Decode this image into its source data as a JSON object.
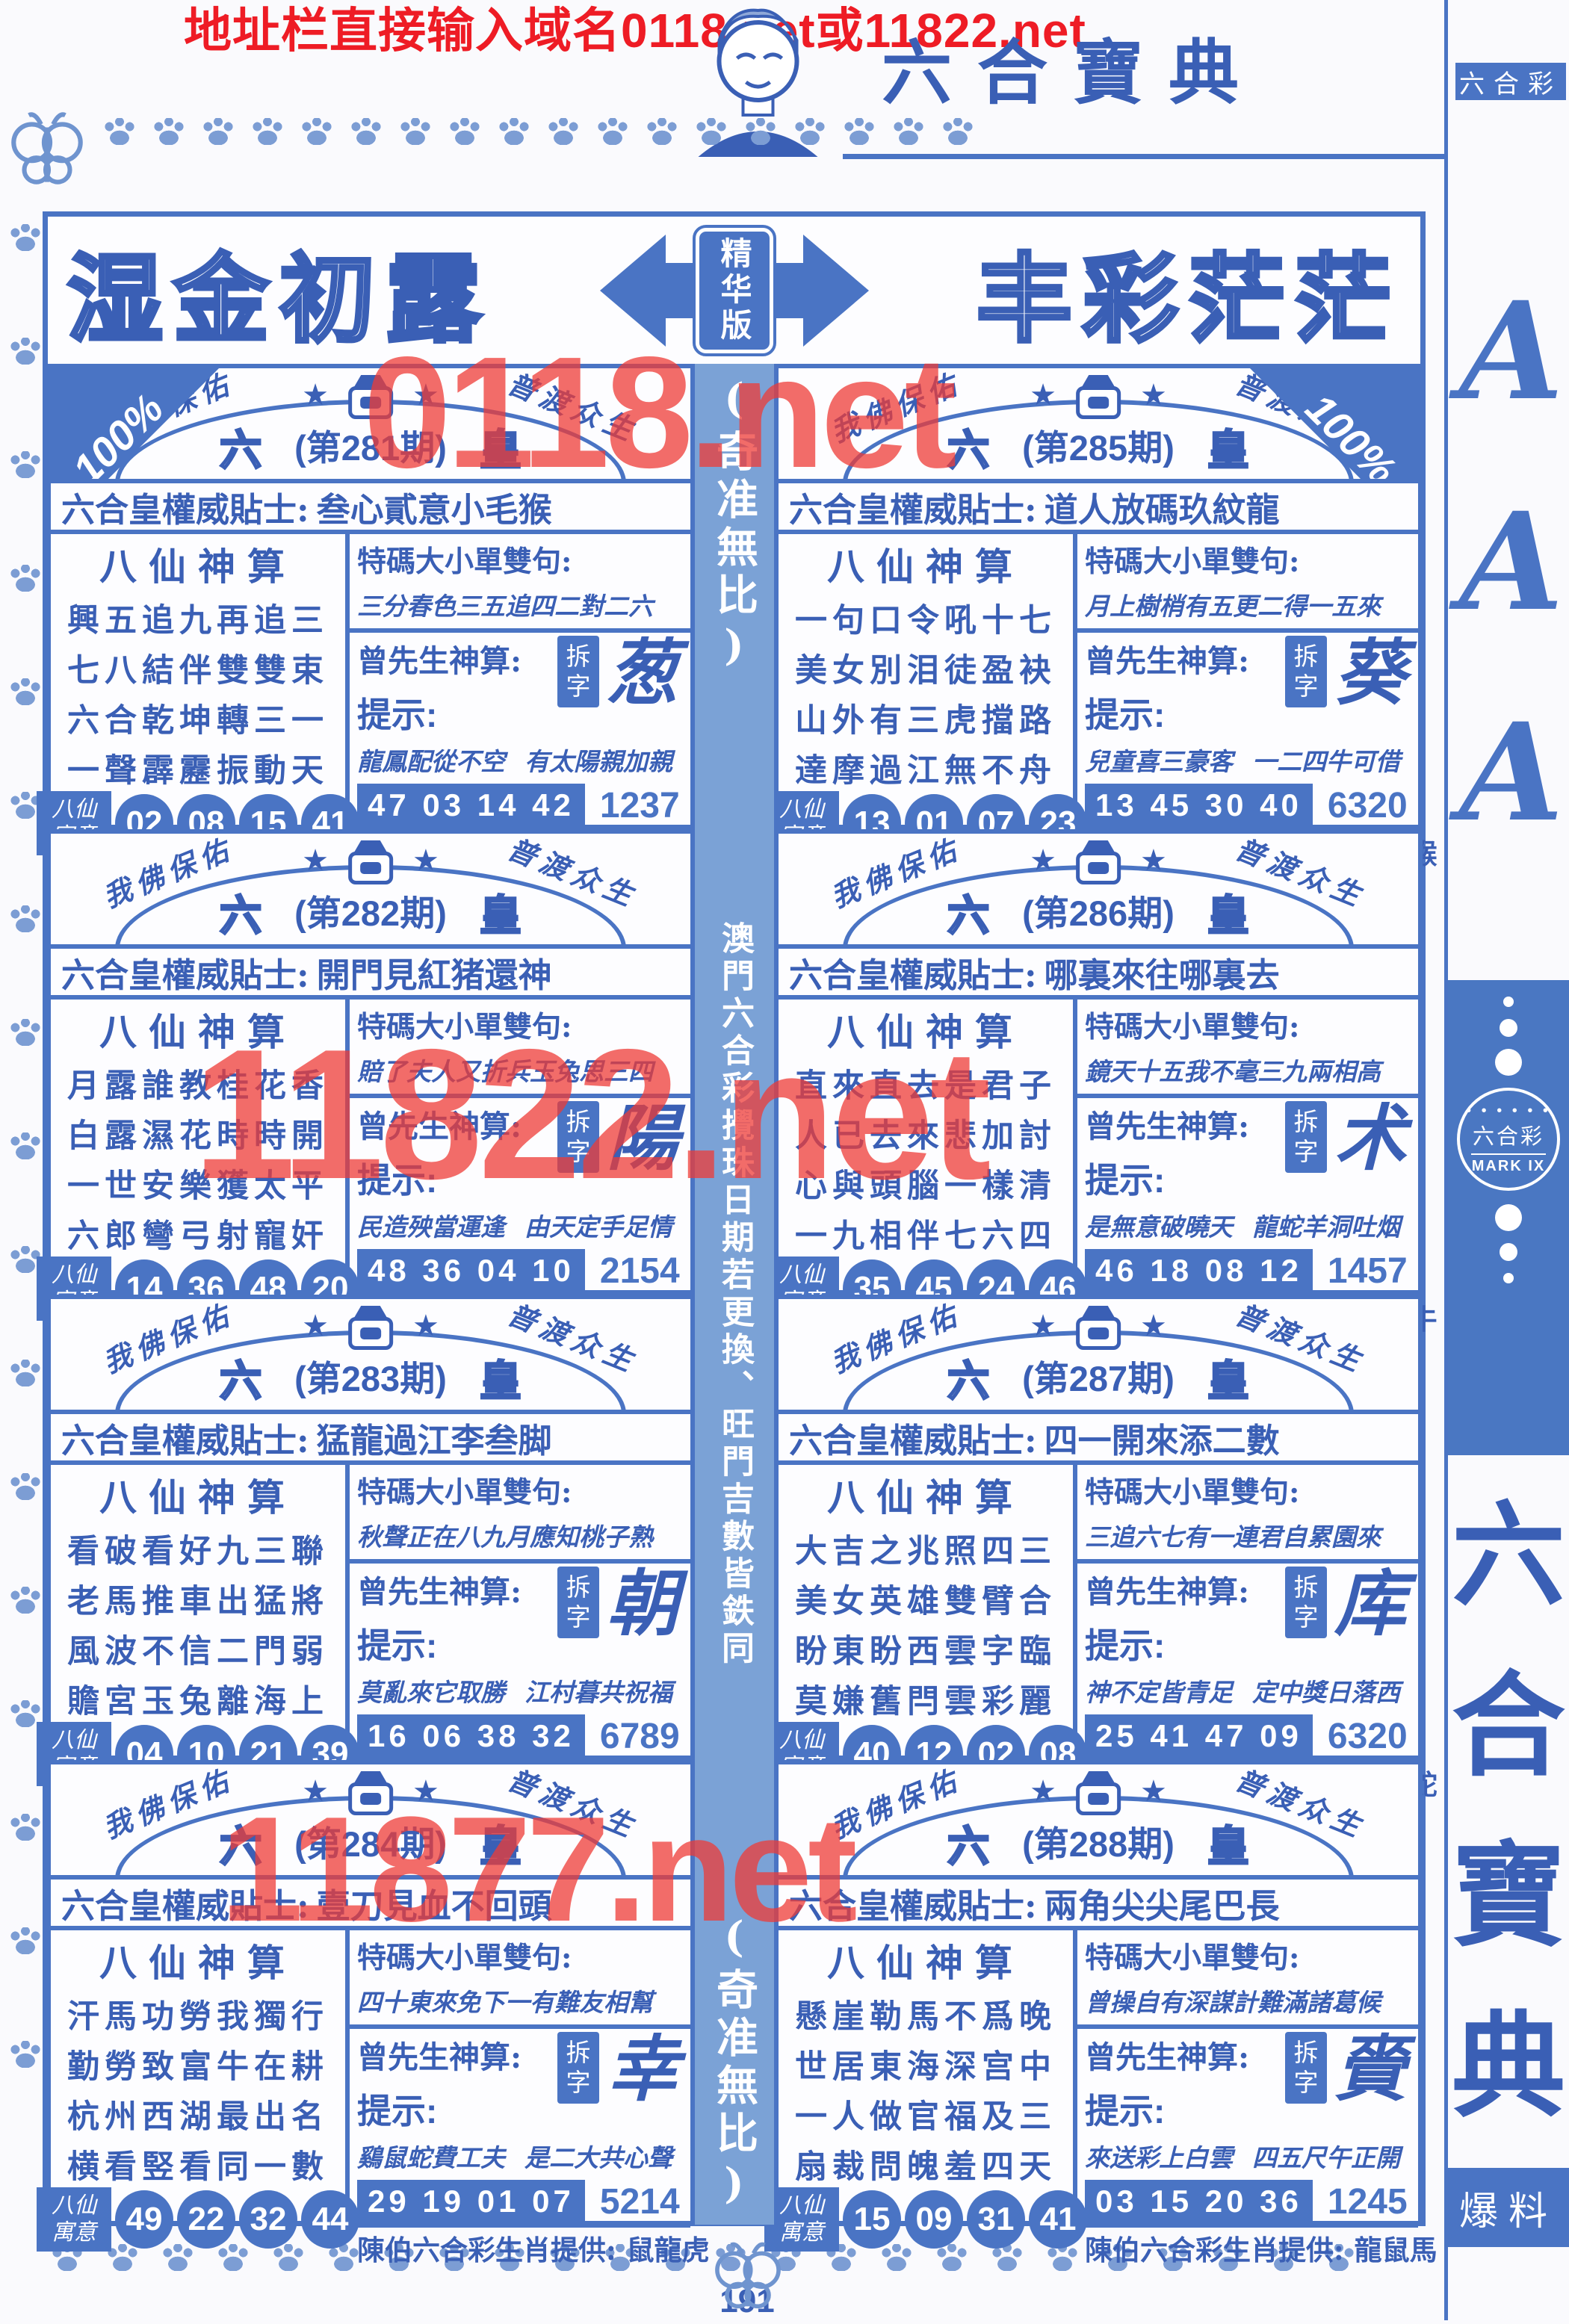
{
  "colors": {
    "accent_blue": "#4a74c4",
    "text_blue": "#3a5fb5",
    "red": "#ee1c25",
    "strip_blue": "#7ba2d6"
  },
  "top_banner": {
    "text": "地址栏直接输入域名0118.net或11822.net"
  },
  "header": {
    "title": "六合寶典"
  },
  "banner": {
    "left_title": "湿金初露",
    "badge": "精华版",
    "right_title": "丰彩茫茫"
  },
  "watermarks": {
    "wm1": "0118.net",
    "wm2": "11822.net",
    "wm3": "11877.net"
  },
  "middle_strip": {
    "top": "(奇准無比)",
    "middle": "澳門六合彩攪珠日期若更換、旺門吉數皆鉄同",
    "bottom": "(奇准無比)"
  },
  "panel_common": {
    "arc_left": "我佛保佑",
    "arc_right": "普渡众生",
    "left_glyph": "六",
    "right_glyph": "皇",
    "corner": "100%",
    "tip_label": "六合皇權威貼士:",
    "baxian_title": "八仙神算",
    "baxian_tag_top": "八仙",
    "baxian_tag_bottom": "寓意",
    "verse_label": "特碼大小單雙句:",
    "zeng_label": "曾先生神算:",
    "chai_top": "拆",
    "chai_bottom": "字",
    "hint_label": "提示:",
    "zodiac_label": "陳伯六合彩生肖提供:"
  },
  "panels": [
    {
      "period": "(第281期)",
      "tip": "叁心貳意小毛猴",
      "poem": [
        "興五追九再追三",
        "七八結伴雙雙束",
        "六合乾坤轉三一",
        "一聲霹靂振動天"
      ],
      "baxian_numbers": [
        "02",
        "08",
        "15",
        "41"
      ],
      "verse": "三分春色三五追四二對二六",
      "chai_char": "葱",
      "hint_left": "龍鳳配從不空",
      "hint_right": "有太陽親加親",
      "numbers": "47 03 14 42",
      "code": "1237",
      "zodiac": "蛇馬鼠"
    },
    {
      "period": "(第285期)",
      "tip": "道人放碼玖紋龍",
      "poem": [
        "一句口令吼十七",
        "美女別泪徒盈袂",
        "山外有三虎擋路",
        "達摩過江無不舟"
      ],
      "baxian_numbers": [
        "13",
        "01",
        "07",
        "23"
      ],
      "verse": "月上樹梢有五更二得一五來",
      "chai_char": "葵",
      "hint_left": "兒童喜三豪客",
      "hint_right": "一二四牛可借",
      "numbers": "13 45 30 40",
      "code": "6320",
      "zodiac": "鶏牛猴"
    },
    {
      "period": "(第282期)",
      "tip": "開門見紅猪還神",
      "poem": [
        "月露誰教桂花香",
        "白露濕花時時開",
        "一世安樂獲太平",
        "六郎彎弓射寵奸"
      ],
      "baxian_numbers": [
        "14",
        "36",
        "48",
        "20"
      ],
      "verse": "賠了夫人又折兵玉兔思三四",
      "chai_char": "陽",
      "hint_left": "民造殃當運逢",
      "hint_right": "由天定手足情",
      "numbers": "48 36 04 10",
      "code": "2154",
      "zodiac": "虎龍猴"
    },
    {
      "period": "(第286期)",
      "tip": "哪裏來往哪裏去",
      "poem": [
        "直來直去是君子",
        "人已去來悲加討",
        "心與頭腦一樣清",
        "一九相伴七六四"
      ],
      "baxian_numbers": [
        "35",
        "45",
        "24",
        "46"
      ],
      "verse": "鏡天十五我不毫三九兩相高",
      "chai_char": "术",
      "hint_left": "是無意破曉天",
      "hint_right": "龍蛇羊洞吐烟",
      "numbers": "46 18 08 12",
      "code": "1457",
      "zodiac": "狗猪牛"
    },
    {
      "period": "(第283期)",
      "tip": "猛龍過江李叁脚",
      "poem": [
        "看破看好九三聯",
        "老馬推車出猛將",
        "風波不信二門弱",
        "贍宮玉兔離海上"
      ],
      "baxian_numbers": [
        "04",
        "10",
        "21",
        "39"
      ],
      "verse": "秋聲正在八九月應知桃子熟",
      "chai_char": "朝",
      "hint_left": "莫亂來它取勝",
      "hint_right": "江村暮共祝福",
      "numbers": "16 06 38 32",
      "code": "6789",
      "zodiac": "兔馬猪"
    },
    {
      "period": "(第287期)",
      "tip": "四一開來添二數",
      "poem": [
        "大吉之兆照四三",
        "美女英雄雙臂合",
        "盼東盼西雲字臨",
        "莫嫌舊閂雲彩麗"
      ],
      "baxian_numbers": [
        "40",
        "12",
        "02",
        "08"
      ],
      "verse": "三追六七有一連君自累園來",
      "chai_char": "库",
      "hint_left": "神不定皆青足",
      "hint_right": "定中獎日落西",
      "numbers": "25 41 47 09",
      "code": "6320",
      "zodiac": "虎兔蛇"
    },
    {
      "period": "(第284期)",
      "tip": "壹刀見血不回頭",
      "poem": [
        "汗馬功勞我獨行",
        "勤勞致富牛在耕",
        "杭州西湖最出名",
        "横看竪看同一數"
      ],
      "baxian_numbers": [
        "49",
        "22",
        "32",
        "44"
      ],
      "verse": "四十東來免下一有難友相幫",
      "chai_char": "幸",
      "hint_left": "鷄鼠蛇費工夫",
      "hint_right": "是二大共心聲",
      "numbers": "29 19 01 07",
      "code": "5214",
      "zodiac": "鼠龍虎"
    },
    {
      "period": "(第288期)",
      "tip": "兩角尖尖尾巴長",
      "poem": [
        "懸崖勒馬不爲晚",
        "世居東海深宫中",
        "一人做官福及三",
        "扇裁問魄羞四天"
      ],
      "baxian_numbers": [
        "15",
        "09",
        "31",
        "41"
      ],
      "verse": "曾操自有深謀計難滿諸葛候",
      "chai_char": "賫",
      "hint_left": "來送彩上白雲",
      "hint_right": "四五尺午正開",
      "numbers": "03 15 20 36",
      "code": "1245",
      "zodiac": "龍鼠馬"
    }
  ],
  "sidebar": {
    "top_label": "六合彩",
    "a1": "A",
    "a2": "A",
    "a3": "A",
    "logo_dots": "• • • • • •",
    "logo_title": "六合彩",
    "logo_mark": "MARK IX",
    "t1": "六",
    "t2": "合",
    "t3": "寶",
    "t4": "典",
    "bottom_label": "爆料"
  },
  "footer": {
    "page_number": "191"
  }
}
